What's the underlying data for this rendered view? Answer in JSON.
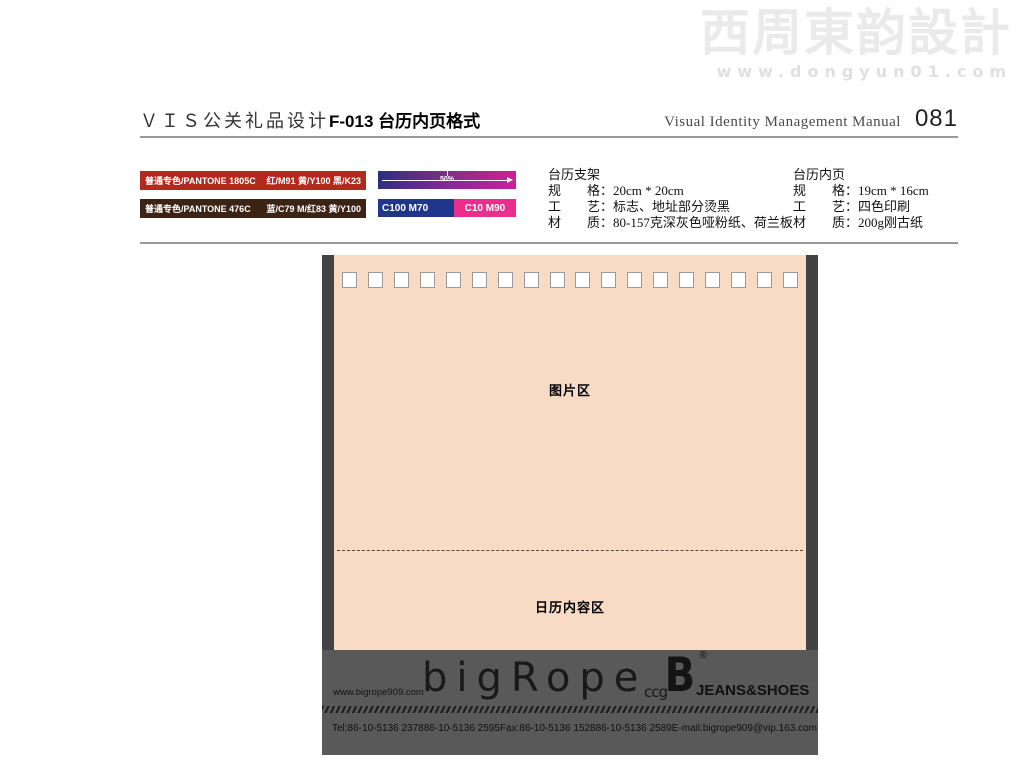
{
  "watermark": {
    "brand": "西周東韵設計",
    "url": "www.dongyun01.com"
  },
  "header": {
    "title_zh": "ＶＩＳ公关礼品设计",
    "title_code": "F-013 台历内页格式",
    "manual_en": "Visual Identity Management Manual",
    "page_no": "081"
  },
  "color_spec": {
    "swatches": [
      {
        "label": "普通专色/PANTONE 1805C",
        "values": "红/M91  黄/Y100  黑/K23",
        "hex": "#b4291d"
      },
      {
        "label": "普通专色/PANTONE 476C",
        "values": "蓝/C79  M/红83  黄/Y100",
        "hex": "#3b2316"
      }
    ],
    "gradient_bar": {
      "label": "50%",
      "from": "#2c2f80",
      "via": "#842c8c",
      "to": "#cb2099"
    },
    "split_bar": {
      "left": {
        "label": "C100 M70",
        "hex": "#20368b"
      },
      "right": {
        "label": "C10 M90",
        "hex": "#ea2e8e"
      }
    }
  },
  "spec_blocks": [
    {
      "title": "台历支架",
      "lines": [
        "规　　格：20cm * 20cm",
        "工　　艺：标志、地址部分烫黑",
        "材　　质：80-157克深灰色哑粉纸、荷兰板"
      ]
    },
    {
      "title": "台历内页",
      "lines": [
        "规　　格：19cm * 16cm",
        "工　　艺：四色印刷",
        "材　　质：200g刚古纸"
      ]
    }
  ],
  "mockup": {
    "hole_count": 18,
    "page_color": "#f8dbc5",
    "picture_area_label": "图片区",
    "calendar_area_label": "日历内容区",
    "footer": {
      "website": "www.bigrope909.com",
      "logo_text": "bigRope",
      "logo_suffix": "ccg",
      "brand_mark": "B",
      "registered_mark": "®",
      "tagline": "JEANS&SHOES",
      "contacts": [
        "Tel:86-10-5136 2378",
        "86-10-5136 2595",
        "Fax:86-10-5136 1528",
        "86-10-5136 2589",
        "E-mail:bigrope909@vip.163.com"
      ]
    }
  }
}
